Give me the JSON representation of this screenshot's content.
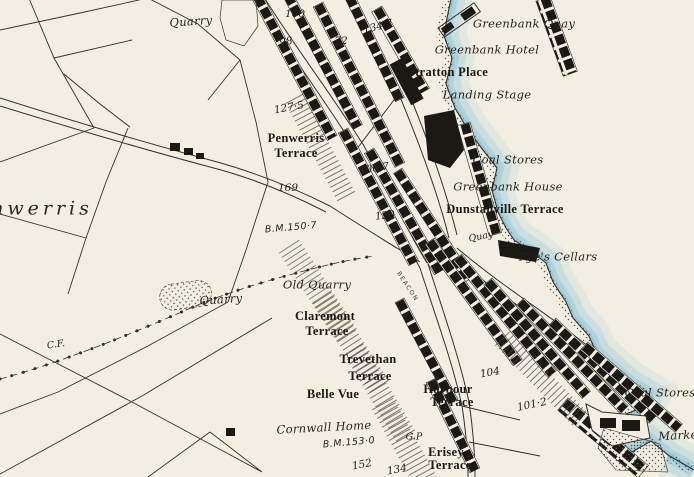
{
  "map": {
    "labels": [
      {
        "text": "Quarry",
        "x": 191,
        "y": 22,
        "rot": -4,
        "style": "ital"
      },
      {
        "text": "100",
        "x": 295,
        "y": 14,
        "rot": 0,
        "style": "num"
      },
      {
        "text": "134·7",
        "x": 378,
        "y": 27,
        "rot": -14,
        "style": "num"
      },
      {
        "text": "Greenbank Quay",
        "x": 524,
        "y": 24,
        "rot": 0,
        "style": "ital"
      },
      {
        "text": "98",
        "x": 286,
        "y": 42,
        "rot": -8,
        "style": "num"
      },
      {
        "text": "72",
        "x": 341,
        "y": 41,
        "rot": 0,
        "style": "num"
      },
      {
        "text": "Greenbank Hotel",
        "x": 487,
        "y": 50,
        "rot": 0,
        "style": "ital"
      },
      {
        "text": "Stratton Place",
        "x": 448,
        "y": 72,
        "rot": 0,
        "style": "bold"
      },
      {
        "text": "Landing Stage",
        "x": 487,
        "y": 95,
        "rot": 0,
        "style": "ital"
      },
      {
        "text": "127·5",
        "x": 289,
        "y": 108,
        "rot": -10,
        "style": "num"
      },
      {
        "text": "Penwerris",
        "x": 296,
        "y": 138,
        "rot": 0,
        "style": "bold"
      },
      {
        "text": "Terrace",
        "x": 296,
        "y": 153,
        "rot": 0,
        "style": "bold"
      },
      {
        "text": "Coal Stores",
        "x": 508,
        "y": 160,
        "rot": 0,
        "style": "ital"
      },
      {
        "text": "106·7",
        "x": 374,
        "y": 169,
        "rot": -8,
        "style": "num"
      },
      {
        "text": "Greenbank House",
        "x": 508,
        "y": 187,
        "rot": 0,
        "style": "ital"
      },
      {
        "text": "169",
        "x": 288,
        "y": 188,
        "rot": 0,
        "style": "num"
      },
      {
        "text": "Dunstanville Terrace",
        "x": 505,
        "y": 209,
        "rot": 0,
        "style": "bold"
      },
      {
        "text": "120",
        "x": 385,
        "y": 216,
        "rot": -6,
        "style": "num"
      },
      {
        "text": "B.M.150·7",
        "x": 291,
        "y": 228,
        "rot": -5,
        "style": "bm"
      },
      {
        "text": "Quay",
        "x": 481,
        "y": 237,
        "rot": -12,
        "style": "ital-sm"
      },
      {
        "text": "Pye's Cellars",
        "x": 558,
        "y": 257,
        "rot": 0,
        "style": "ital"
      },
      {
        "text": "Old Quarry",
        "x": 317,
        "y": 285,
        "rot": 0,
        "style": "ital"
      },
      {
        "text": "Quarry",
        "x": 221,
        "y": 300,
        "rot": -4,
        "style": "ital"
      },
      {
        "text": "BEACON",
        "x": 407,
        "y": 287,
        "rot": 57,
        "style": "street"
      },
      {
        "text": "Claremont",
        "x": 325,
        "y": 316,
        "rot": 0,
        "style": "bold"
      },
      {
        "text": "Terrace",
        "x": 327,
        "y": 331,
        "rot": 0,
        "style": "bold"
      },
      {
        "text": "C.F.",
        "x": 56,
        "y": 345,
        "rot": -8,
        "style": "ital-sm"
      },
      {
        "text": "Trevethan",
        "x": 368,
        "y": 359,
        "rot": 0,
        "style": "bold"
      },
      {
        "text": "Terrace",
        "x": 370,
        "y": 376,
        "rot": 0,
        "style": "bold"
      },
      {
        "text": "104",
        "x": 490,
        "y": 373,
        "rot": -10,
        "style": "num"
      },
      {
        "text": "Belle Vue",
        "x": 333,
        "y": 394,
        "rot": 0,
        "style": "bold"
      },
      {
        "text": "Harbour",
        "x": 448,
        "y": 389,
        "rot": 0,
        "style": "bold"
      },
      {
        "text": "Terrace",
        "x": 452,
        "y": 402,
        "rot": 0,
        "style": "bold"
      },
      {
        "text": "Coal Stores",
        "x": 660,
        "y": 393,
        "rot": 0,
        "style": "ital"
      },
      {
        "text": "101·2",
        "x": 532,
        "y": 405,
        "rot": -12,
        "style": "num"
      },
      {
        "text": "Cornwall Home",
        "x": 324,
        "y": 428,
        "rot": -3,
        "style": "ital"
      },
      {
        "text": "G.P",
        "x": 414,
        "y": 437,
        "rot": 0,
        "style": "ital-sm"
      },
      {
        "text": "B.M.153·0",
        "x": 349,
        "y": 443,
        "rot": -5,
        "style": "bm"
      },
      {
        "text": "Erisey",
        "x": 446,
        "y": 452,
        "rot": 0,
        "style": "bold"
      },
      {
        "text": "Terrace",
        "x": 450,
        "y": 465,
        "rot": 0,
        "style": "bold"
      },
      {
        "text": "152",
        "x": 362,
        "y": 465,
        "rot": -10,
        "style": "num"
      },
      {
        "text": "134",
        "x": 397,
        "y": 470,
        "rot": -10,
        "style": "num"
      },
      {
        "text": "nwerris",
        "x": 42,
        "y": 209,
        "rot": 0,
        "style": "district"
      },
      {
        "text": "Marke",
        "x": 678,
        "y": 436,
        "rot": -3,
        "style": "ital"
      }
    ]
  },
  "colors": {
    "paper": "#f2efe2",
    "water": "#8ec6dc",
    "ink": "#35312a",
    "building": "#1b1914",
    "stipple": "#56524a",
    "label": "#26221a"
  }
}
